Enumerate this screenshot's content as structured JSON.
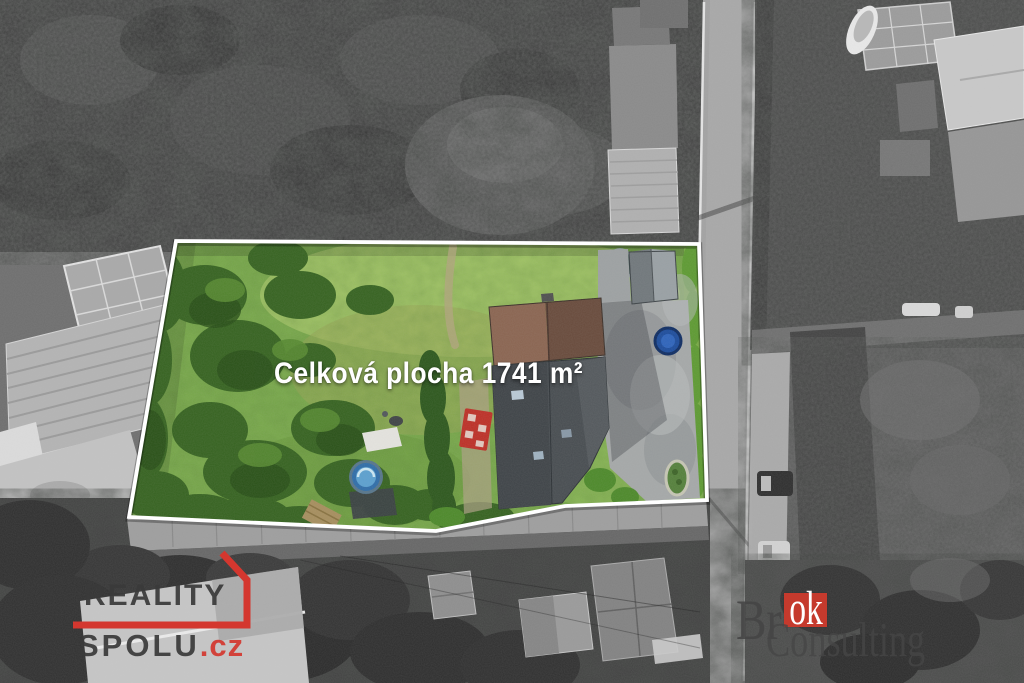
{
  "parcel": {
    "area_label": "Celková plocha 1741 m²",
    "outline_color": "#ffffff",
    "label_color": "#ffffff"
  },
  "branding": {
    "reality_spolu": {
      "line1": "REALITY",
      "line2": "SPOLU",
      "domain_suffix": ".cz",
      "accent_color": "#d4372f",
      "text_color": "#3a3a3a"
    },
    "brok_consulting": {
      "prefix": "Br",
      "highlight": "ok",
      "line2": "Consulting",
      "square_color": "#c53a2d",
      "text_color": "#464646"
    }
  }
}
